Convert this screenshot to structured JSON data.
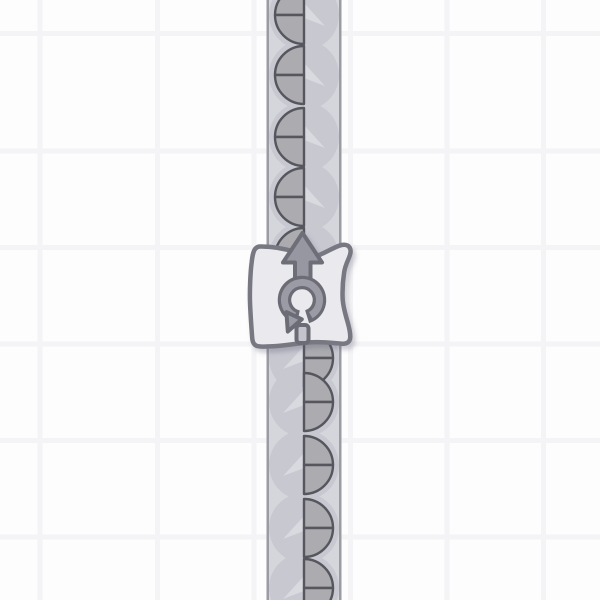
{
  "app": {
    "type": "factory-game",
    "view": "conveyor-with-rotator"
  },
  "grid": {
    "cell_color": "#fdfdfd",
    "line_color": "#f4f4f6",
    "pitch": 96.5,
    "line_width": 5,
    "offset_x": 63.5,
    "offset_y": 57
  },
  "belt": {
    "direction": "up",
    "center_x": 304,
    "inner_left": 269,
    "inner_right": 339,
    "edge_width": 2.5,
    "fill": "#d5d5dc",
    "edge_color": "#9b9ba4",
    "pad_color": "#c8c8d1",
    "pad_radius": 35,
    "chevron_color": "#d9d9e0"
  },
  "items": {
    "kind": "half-circle-shape-two-quadrants",
    "radius": 29,
    "fill": "#acacb0",
    "outline": "#56565f",
    "outline_width": 2.4,
    "groups": [
      {
        "name": "output-items",
        "half": "left",
        "centers_y": [
          15,
          75,
          137,
          197,
          257
        ]
      },
      {
        "name": "input-items",
        "half": "right",
        "centers_y": [
          358,
          402,
          465,
          528,
          588
        ]
      }
    ]
  },
  "building": {
    "name": "rotator",
    "rotation": "ccw",
    "output_direction": "up",
    "body_fill": "#e9e9ee",
    "body_stroke": "#787882",
    "body_stroke_width": 4.5,
    "icon_fill": "#9b9ba5",
    "icon_stroke": "#6c6c76",
    "arrow_fill": "#9797a1",
    "arrow_stroke": "#6e6e78",
    "peg_fill": "#c4c4cd",
    "shadow_color": "#5a5a73",
    "shadow_opacity": 0.3
  }
}
